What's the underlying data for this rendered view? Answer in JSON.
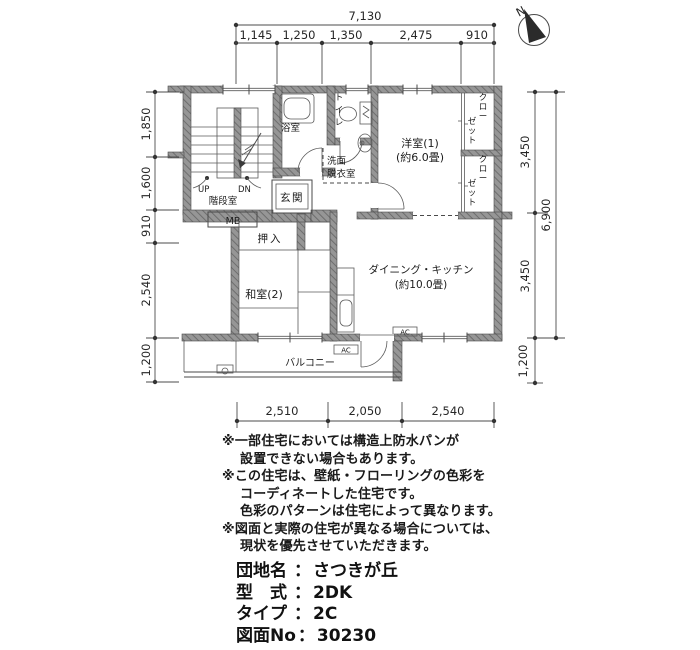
{
  "colors": {
    "wall_hatch": "#969696",
    "line": "#4a4a4a",
    "text": "#1c1c1c"
  },
  "compass": {
    "north": "N"
  },
  "dims": {
    "top_total": "7,130",
    "top": [
      "1,145",
      "1,250",
      "1,350",
      "2,475",
      "910"
    ],
    "left": [
      "1,850",
      "1,600",
      "910",
      "2,540",
      "1,200"
    ],
    "right": [
      "3,450",
      "3,450"
    ],
    "right_total": "6,900",
    "right_balcony": "1,200",
    "bottom": [
      "2,510",
      "2,050",
      "2,540"
    ]
  },
  "rooms": {
    "stair": "階段室",
    "up": "UP",
    "dn": "DN",
    "mb": "MB",
    "genkan": "玄関",
    "bath": "浴室",
    "toilet": "トイレ",
    "wash1": "洗面",
    "wash2": "脱衣室",
    "western": "洋室(1)",
    "western_size": "(約6.0畳)",
    "closet_l1": "クロー",
    "closet_l2": "ゼット",
    "oshiire": "押入",
    "washitsu": "和室(2)",
    "dk": "ダイニング・キッチン",
    "dk_size": "(約10.0畳)",
    "balcony": "バルコニー",
    "ac": "AC"
  },
  "notes": {
    "lines": [
      "※一部住宅においては構造上防水パンが",
      "設置できない場合もあります。",
      "※この住宅は、壁紙・フローリングの色彩を",
      "コーディネートした住宅です。",
      "色彩のパターンは住宅によって異なります。",
      "※図面と実際の住宅が異なる場合については、",
      "現状を優先させていただきます。"
    ]
  },
  "property": {
    "separator": "：",
    "items": [
      {
        "label": "団地名",
        "value": "さつきが丘"
      },
      {
        "label": "型　式",
        "value": "2DK"
      },
      {
        "label": "タイプ",
        "value": "2C"
      },
      {
        "label": "図面No",
        "value": "30230"
      }
    ]
  }
}
